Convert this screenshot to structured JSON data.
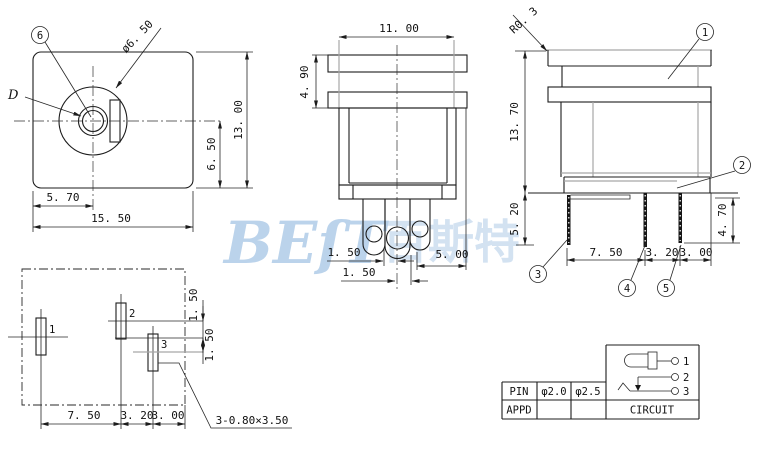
{
  "watermark": {
    "latin": "BEſT",
    "cjk": "百斯特"
  },
  "front_view": {
    "balloon_6": "6",
    "d_label": "D",
    "diameter_label": "ø6. 50",
    "dim_height": "13. 00",
    "dim_center_height": "6. 50",
    "dim_center_offset": "5. 70",
    "dim_width": "15. 50"
  },
  "top_view": {
    "dim_width": "11. 00",
    "dim_flange": "4. 90",
    "dim_pin_offset_a": "1. 50",
    "dim_pin_offset_b": "1. 50",
    "dim_pin_right": "5. 00"
  },
  "side_view": {
    "radius_label": "R0. 3",
    "balloon_1": "1",
    "balloon_2": "2",
    "balloon_3": "3",
    "balloon_4": "4",
    "balloon_5": "5",
    "dim_height": "13. 70",
    "dim_pin_left": "5. 20",
    "dim_pin_right": "4. 70",
    "dim_pitch_a": "7. 50",
    "dim_pitch_b": "3. 20",
    "dim_pitch_c": "3. 00"
  },
  "pcb_view": {
    "pad_1": "1",
    "pad_2": "2",
    "pad_3": "3",
    "dim_offset_a": "1. 50",
    "dim_offset_b": "1. 50",
    "dim_pitch_a": "7. 50",
    "dim_pitch_b": "3. 20",
    "dim_pitch_c": "3. 00",
    "slot_note": "3-0.80×3.50"
  },
  "spec_table": {
    "row1": [
      "PIN",
      "φ2.0",
      "φ2.5"
    ],
    "row2_label": "APPD",
    "circuit_label": "CIRCUIT",
    "terminal_1": "1",
    "terminal_2": "2",
    "terminal_3": "3"
  }
}
